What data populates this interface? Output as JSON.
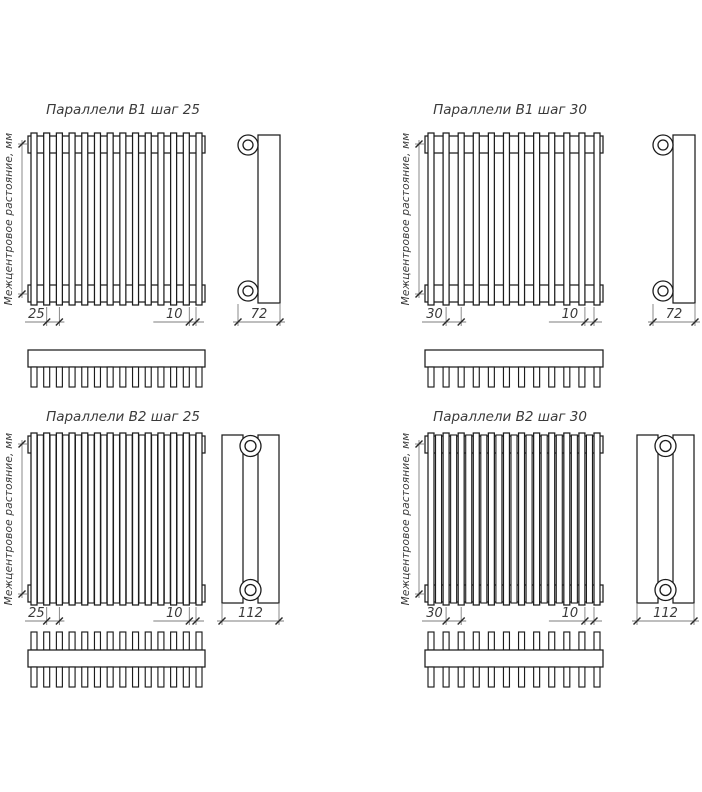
{
  "axis_label": "Межцентровое растояние, мм",
  "diagrams": [
    {
      "id": "parallels-b1-step-25",
      "title": "Параллели В1 шаг 25",
      "rows": 1,
      "tube_count": 14,
      "dims": {
        "step": "25",
        "gap": "10",
        "depth": "72"
      }
    },
    {
      "id": "parallels-b1-step-30",
      "title": "Параллели В1 шаг 30",
      "rows": 1,
      "tube_count": 12,
      "dims": {
        "step": "30",
        "gap": "10",
        "depth": "72"
      }
    },
    {
      "id": "parallels-b2-step-25",
      "title": "Параллели В2 шаг 25",
      "rows": 2,
      "tube_count": 14,
      "dims": {
        "step": "25",
        "gap": "10",
        "depth": "112"
      }
    },
    {
      "id": "parallels-b2-step-30",
      "title": "Параллели В2 шаг 30",
      "rows": 2,
      "tube_count": 12,
      "dims": {
        "step": "30",
        "gap": "10",
        "depth": "112"
      }
    }
  ],
  "colors": {
    "background": "#ffffff",
    "line": "#1c1c1c",
    "dim_line": "#7d7d7d",
    "tick": "#2a2a2a",
    "text": "#3a3a3a"
  }
}
